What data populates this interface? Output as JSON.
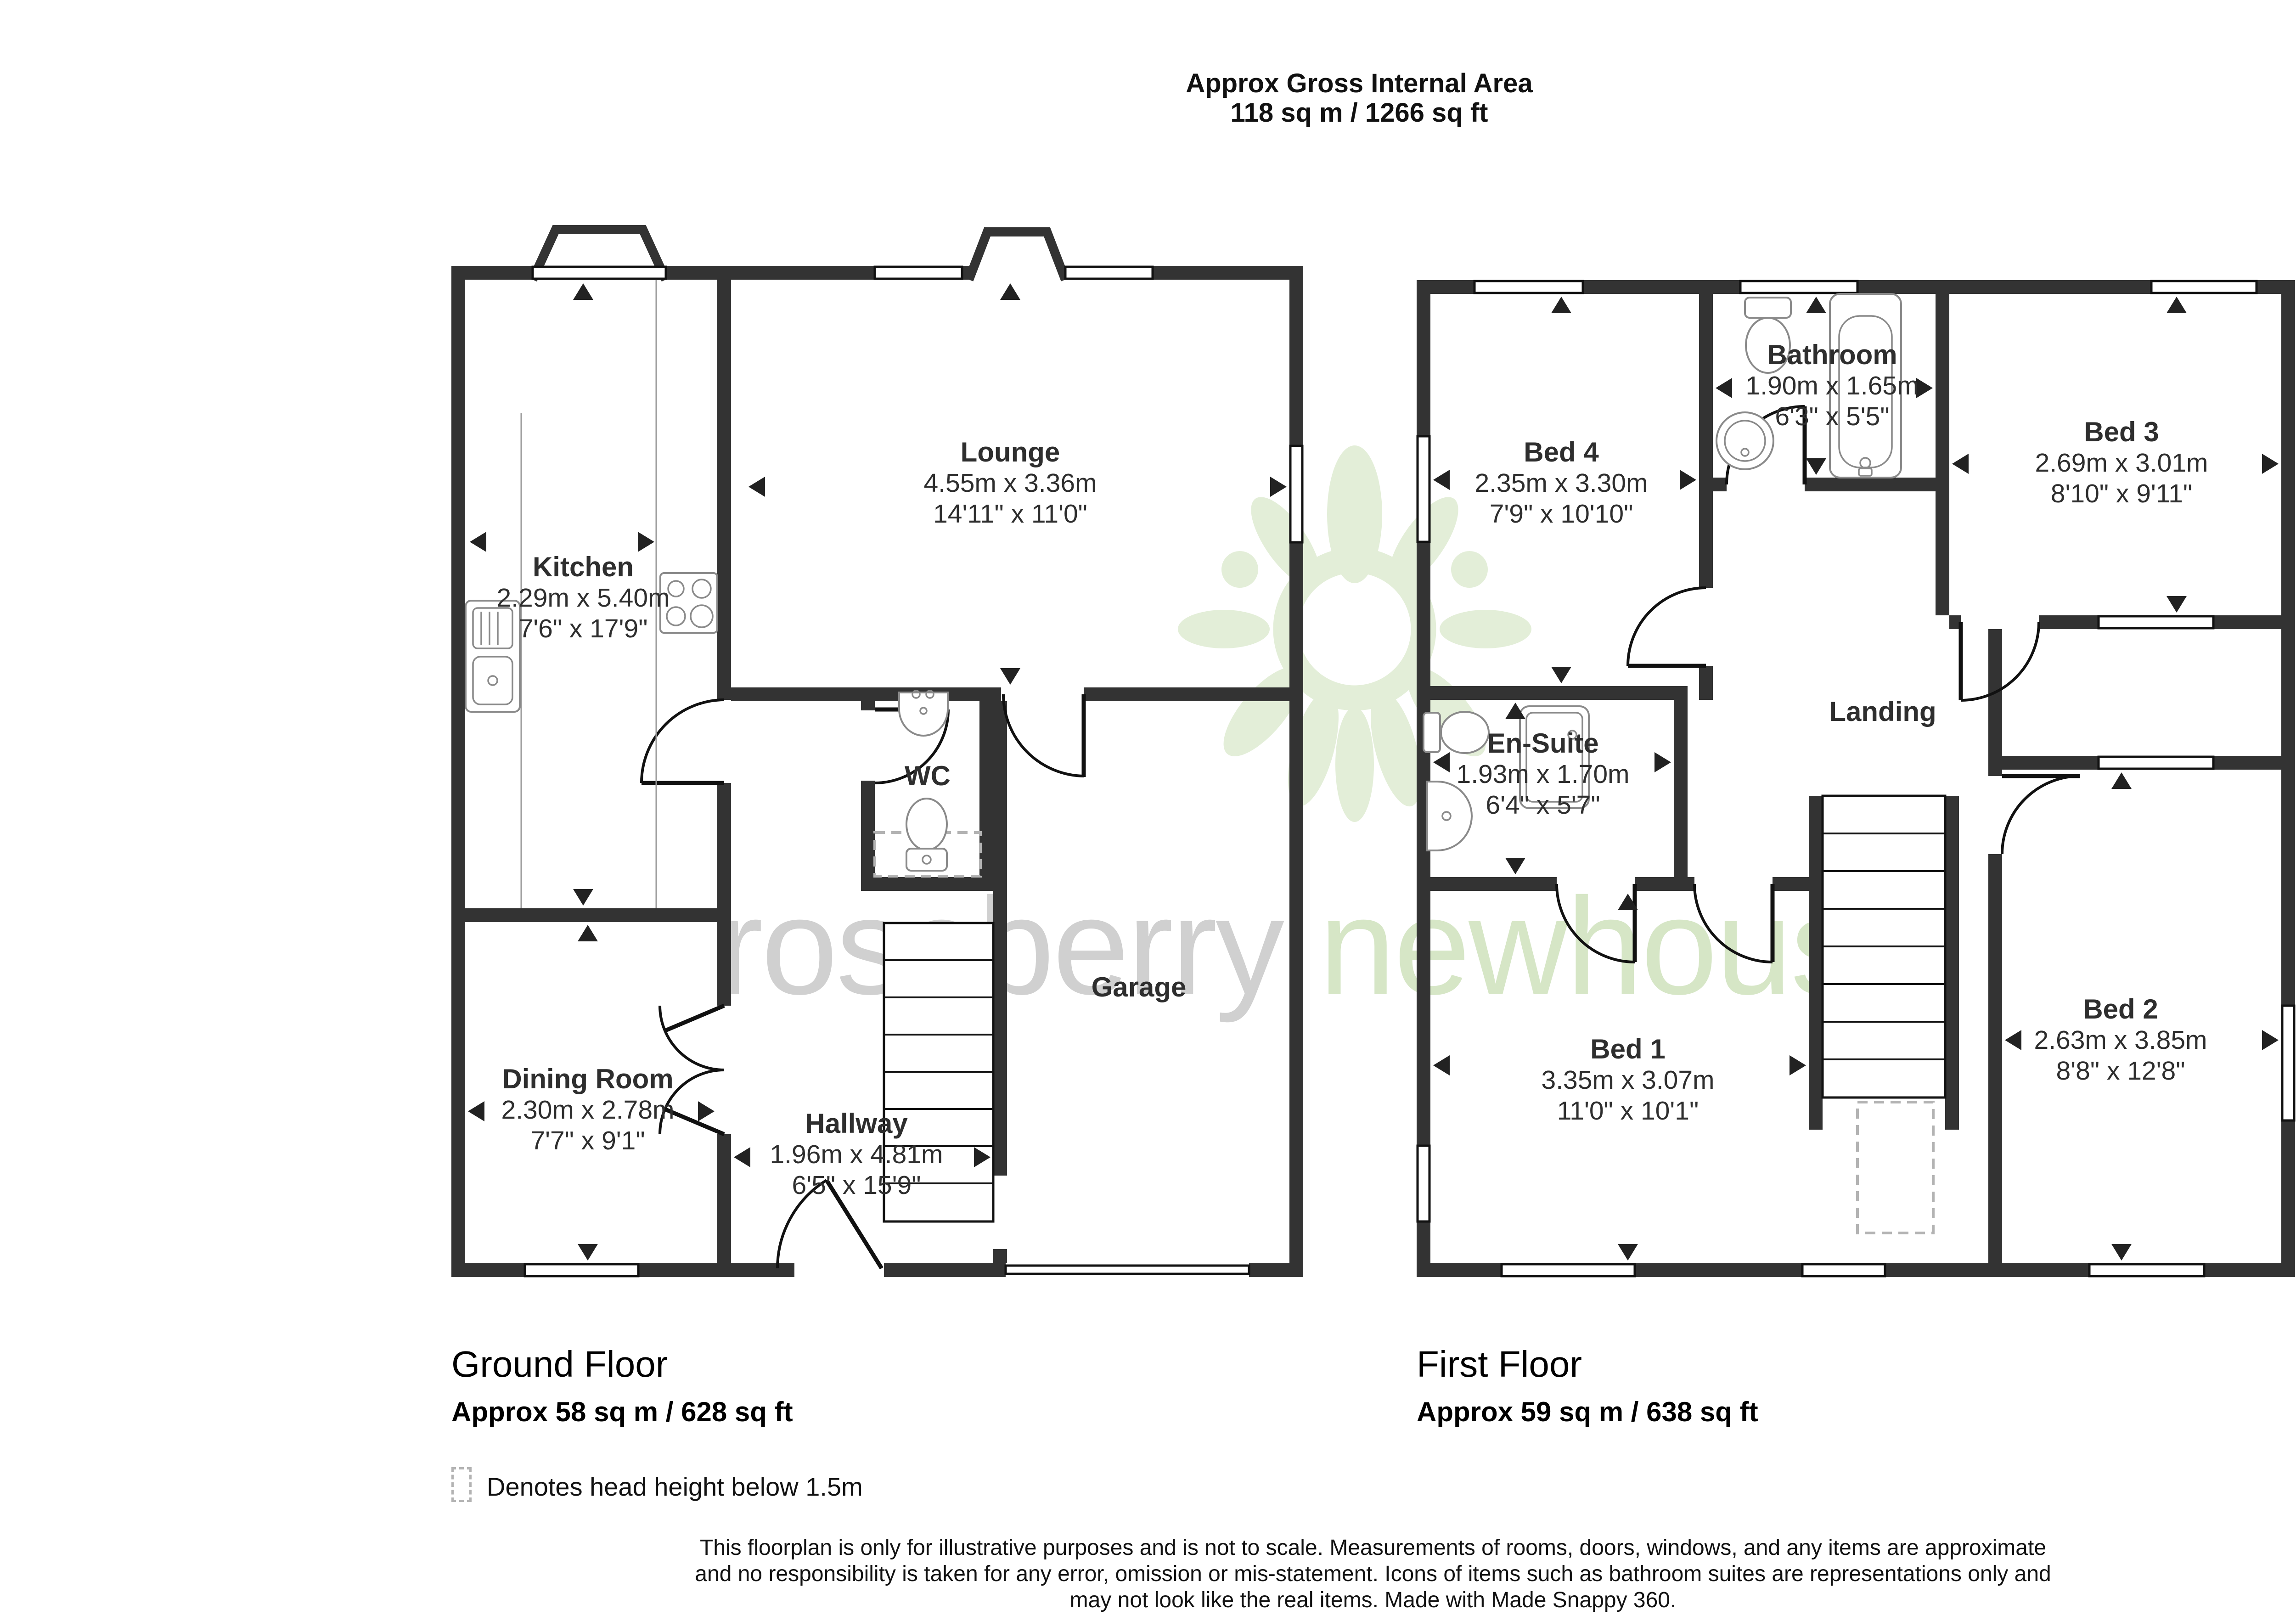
{
  "header": {
    "line1": "Approx Gross Internal Area",
    "line2": "118 sq m / 1266 sq ft"
  },
  "compass": {
    "n": "N",
    "e": "E",
    "s": "S",
    "w": "W"
  },
  "watermark": {
    "part1": "roseberry",
    "part2": "newhouse"
  },
  "ground_floor": {
    "label": "Ground Floor",
    "area": "Approx 58 sq m / 628 sq ft",
    "rooms": [
      {
        "name": "Kitchen",
        "metric": "2.29m x 5.40m",
        "imperial": "7'6\" x 17'9\""
      },
      {
        "name": "Lounge",
        "metric": "4.55m x 3.36m",
        "imperial": "14'11\" x 11'0\""
      },
      {
        "name": "WC"
      },
      {
        "name": "Dining Room",
        "metric": "2.30m x 2.78m",
        "imperial": "7'7\" x 9'1\""
      },
      {
        "name": "Hallway",
        "metric": "1.96m x 4.81m",
        "imperial": "6'5\" x 15'9\""
      },
      {
        "name": "Garage"
      }
    ]
  },
  "first_floor": {
    "label": "First Floor",
    "area": "Approx 59 sq m / 638 sq ft",
    "rooms": [
      {
        "name": "Bed 4",
        "metric": "2.35m x 3.30m",
        "imperial": "7'9\" x 10'10\""
      },
      {
        "name": "Bathroom",
        "metric": "1.90m x 1.65m",
        "imperial": "6'3\" x 5'5\""
      },
      {
        "name": "Bed 3",
        "metric": "2.69m x 3.01m",
        "imperial": "8'10\" x 9'11\""
      },
      {
        "name": "En-Suite",
        "metric": "1.93m x 1.70m",
        "imperial": "6'4\" x 5'7\""
      },
      {
        "name": "Landing"
      },
      {
        "name": "Bed 1",
        "metric": "3.35m x 3.07m",
        "imperial": "11'0\" x 10'1\""
      },
      {
        "name": "Bed 2",
        "metric": "2.63m x 3.85m",
        "imperial": "8'8\" x 12'8\""
      }
    ]
  },
  "legend": {
    "label": "Denotes head height below 1.5m"
  },
  "footer": {
    "line1": "This floorplan is only for illustrative purposes and is not to scale. Measurements of rooms, doors, windows, and any items are approximate",
    "line2": "and no responsibility is taken for any error, omission or mis-statement. Icons of items such as bathroom suites are representations only and",
    "line3": "may not look like the real items. Made with Made Snappy 360."
  },
  "colors": {
    "wall": "#333333",
    "detail_line": "#111111",
    "fixture_outline": "#8a8a8a",
    "watermark_gray": "#c8c8c8",
    "watermark_green": "#cfe2bd",
    "logo_green": "#e0edd4"
  }
}
